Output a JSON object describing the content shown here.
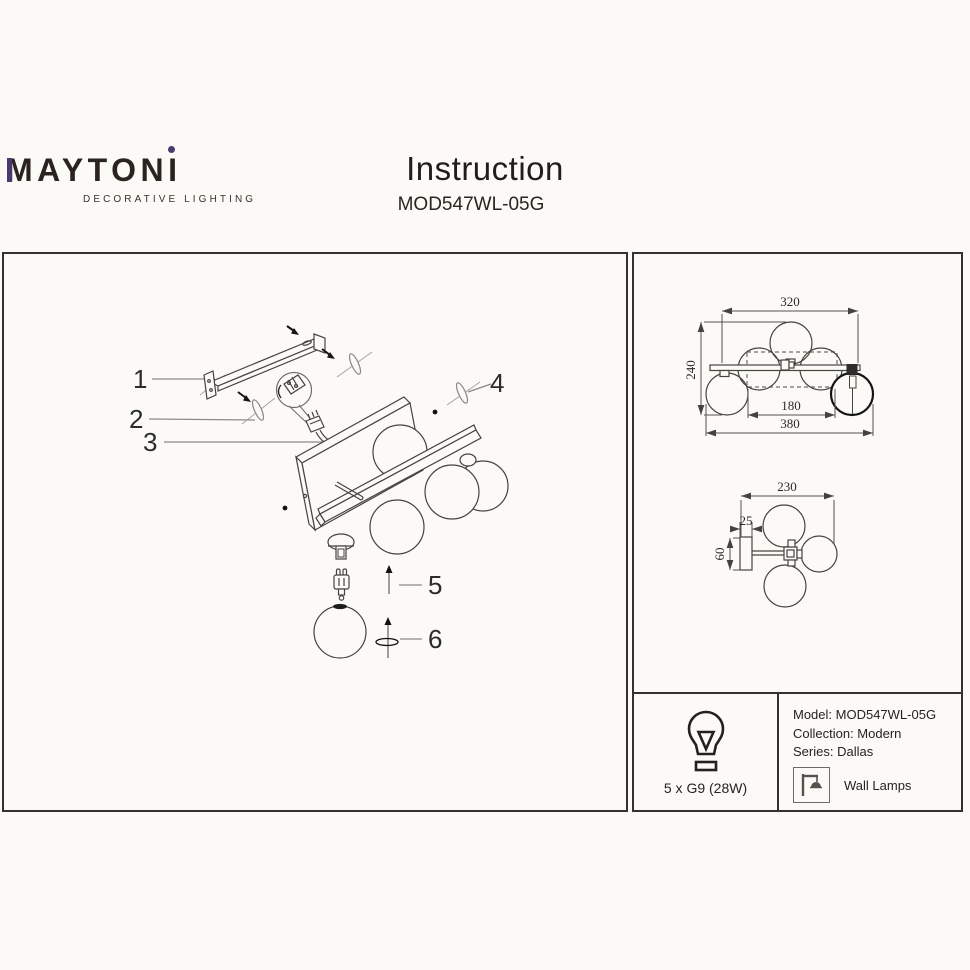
{
  "header": {
    "brand_left": "MAYTON",
    "brand_i": "I",
    "tagline": "DECORATIVE LIGHTING",
    "title": "Instruction",
    "model": "MOD547WL-05G"
  },
  "diagram": {
    "labels": [
      "1",
      "2",
      "3",
      "4",
      "5",
      "6"
    ]
  },
  "dims": {
    "front_top": "320",
    "front_left": "240",
    "front_mid": "180",
    "front_bottom": "380",
    "side_top": "230",
    "side_depth": "25",
    "side_height": "60"
  },
  "specs": {
    "bulbs": "5 x G9 (28W)",
    "model": "Model: MOD547WL-05G",
    "collection": "Collection: Modern",
    "series": "Series: Dallas",
    "category": "Wall Lamps"
  },
  "colors": {
    "accent_purple": "#4b3a70",
    "ink": "#2b2320",
    "line": "#46443f"
  }
}
